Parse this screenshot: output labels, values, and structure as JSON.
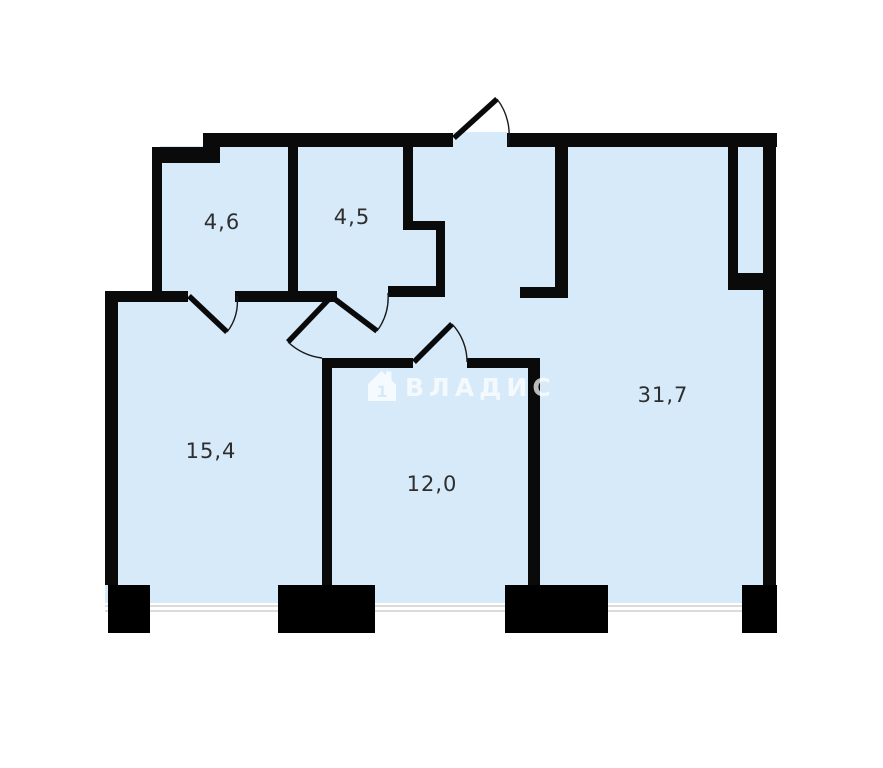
{
  "floorplan": {
    "title": "apartment-floor-plan",
    "rooms": [
      {
        "id": "top-left-small-room",
        "area_label": "4,6"
      },
      {
        "id": "top-middle-small-room",
        "area_label": "4,5"
      },
      {
        "id": "right-large-room",
        "area_label": "31,7"
      },
      {
        "id": "bottom-left-room",
        "area_label": "15,4"
      },
      {
        "id": "bottom-middle-room",
        "area_label": "12,0"
      }
    ],
    "watermark": {
      "text": "ВЛАДИС",
      "icon": "house-number-1-icon",
      "icon_digit": "1"
    },
    "colors": {
      "room_fill": "#d6eafa",
      "walls": "#0a0a0a",
      "window_line": "#cfcfcf",
      "label_text": "#2e2e2e",
      "watermark": "#ffffff",
      "background": "#ffffff"
    }
  }
}
